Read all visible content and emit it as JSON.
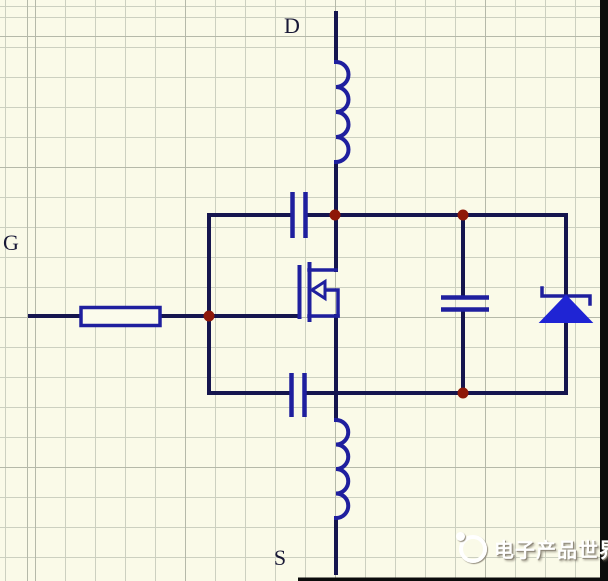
{
  "colors": {
    "background": "#fafae8",
    "grid_minor": "#ccd0c0",
    "grid_major": "#b5b9a9",
    "wire": "#15154e",
    "component": "#1f1f9e",
    "diode_fill": "#1f24d4",
    "junction_dot": "#8e1808",
    "label": "#181836",
    "border": "#0c0c0c",
    "resistor_fill": "#fbfbec",
    "arrow_fill": "#f8f8e6",
    "watermark_text_color": "#ffffff",
    "watermark_shadow": "#8f897a"
  },
  "labels": {
    "drain": "D",
    "gate": "G",
    "source": "S"
  },
  "components": [
    {
      "id": "inductor-drain",
      "type": "inductor"
    },
    {
      "id": "capacitor-gate-drain",
      "type": "capacitor"
    },
    {
      "id": "resistor-gate",
      "type": "resistor"
    },
    {
      "id": "mosfet-n-channel",
      "type": "mosfet"
    },
    {
      "id": "capacitor-gate-source",
      "type": "capacitor"
    },
    {
      "id": "capacitor-drain-source",
      "type": "capacitor"
    },
    {
      "id": "diode-zener",
      "type": "zener-diode"
    },
    {
      "id": "inductor-source",
      "type": "inductor"
    }
  ],
  "watermark": {
    "text": "电子产品世界",
    "logo": "eepw-logo"
  }
}
